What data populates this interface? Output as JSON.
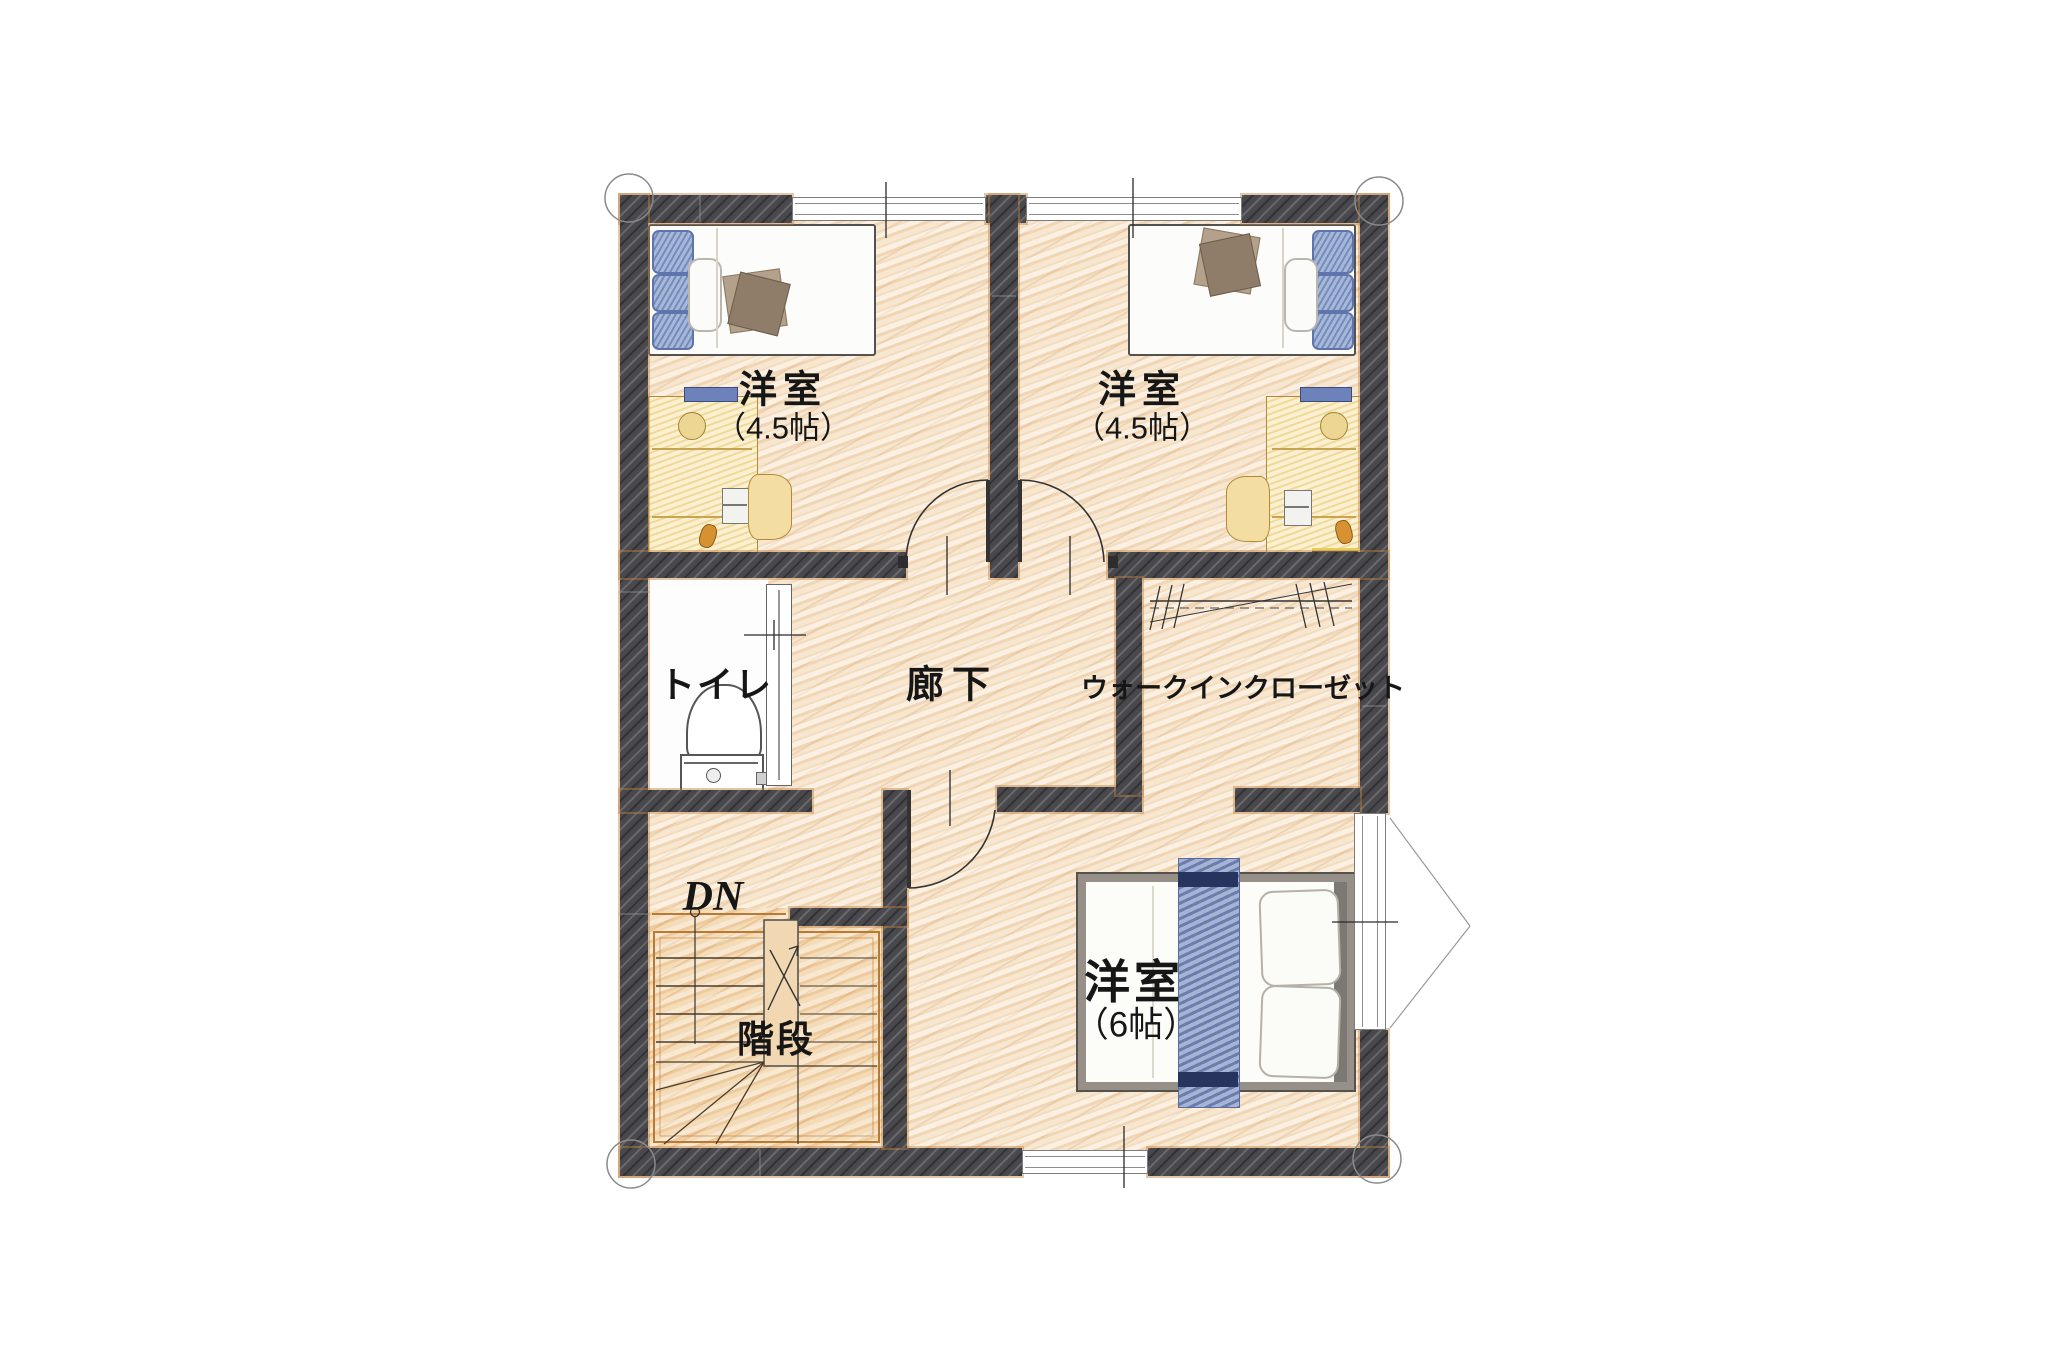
{
  "floor_plan": {
    "rooms": {
      "bedroom_left": {
        "name": "洋室",
        "size": "（4.5帖）"
      },
      "bedroom_right": {
        "name": "洋室",
        "size": "（4.5帖）"
      },
      "bedroom_main": {
        "name": "洋室",
        "size": "（6帖）"
      },
      "toilet": {
        "name": "トイレ"
      },
      "hallway": {
        "name": "廊下"
      },
      "closet": {
        "name": "ウォークインクローゼット"
      },
      "stairs": {
        "name": "階段",
        "direction_label": "DN"
      }
    },
    "colors": {
      "wall": "#49484c",
      "floor_wood": "#f6e2c8",
      "floor_stairs": "#f3d7af",
      "trim_orange": "#b97a36",
      "bed_blue": "#89a0cc",
      "runner_blue": "#8296c4",
      "navy": "#2e3c66",
      "desk_yellow": "#f8e6b0",
      "blanket_brown": "#8f7d6a"
    }
  }
}
